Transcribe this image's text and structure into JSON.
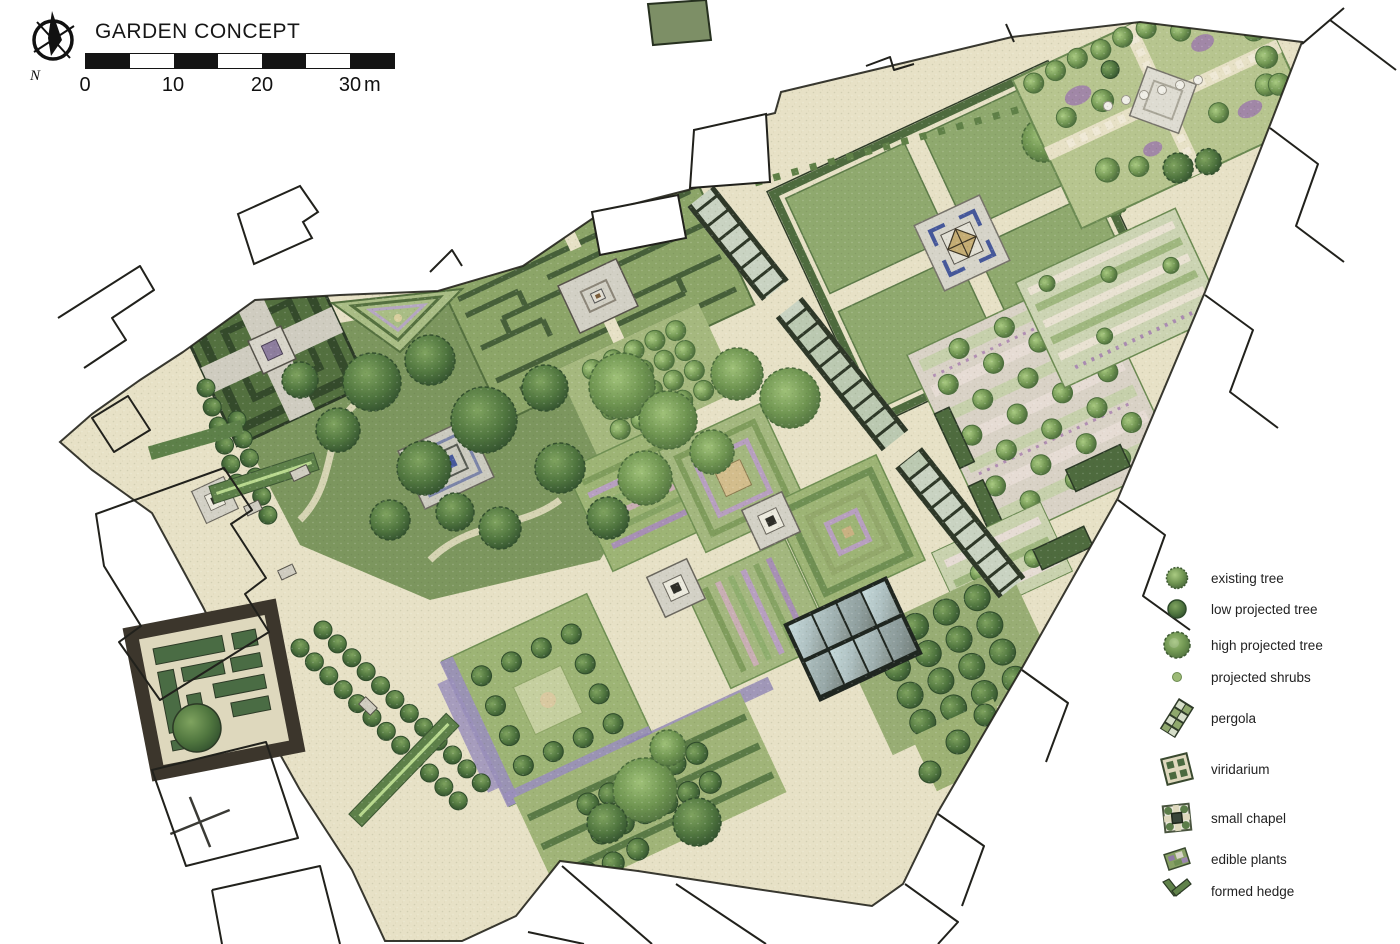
{
  "title": "GARDEN CONCEPT",
  "compass": {
    "label": "N"
  },
  "scale_bar": {
    "labels": [
      "0",
      "10",
      "20",
      "30"
    ],
    "unit": "m"
  },
  "legend": {
    "items": [
      {
        "icon": "existing-tree-icon",
        "label": "existing tree"
      },
      {
        "icon": "low-projected-tree-icon",
        "label": "low projected tree"
      },
      {
        "icon": "high-projected-tree-icon",
        "label": "high projected tree"
      },
      {
        "icon": "projected-shrubs-icon",
        "label": "projected shrubs"
      },
      {
        "icon": "pergola-icon",
        "label": "pergola"
      },
      {
        "icon": "viridarium-icon",
        "label": "viridarium"
      },
      {
        "icon": "small-chapel-icon",
        "label": "small chapel"
      },
      {
        "icon": "edible-plants-icon",
        "label": "edible plants"
      },
      {
        "icon": "formed-hedge-icon",
        "label": "formed hedge"
      }
    ]
  },
  "palette": {
    "ground_beige": "#e7e1c6",
    "lawn_green": "#8fa96e",
    "bed_green": "#a3b77e",
    "hedge_dark": "#4e6b3e",
    "tree_green": "#6e9350",
    "water_blue": "#46589a",
    "pavilion_tan": "#c5ad74",
    "plaza_gray": "#d3d1c6",
    "outline_dark": "#21211c",
    "flower_purple": "#9a86b5",
    "glass_blue": "#b9cfd2"
  }
}
